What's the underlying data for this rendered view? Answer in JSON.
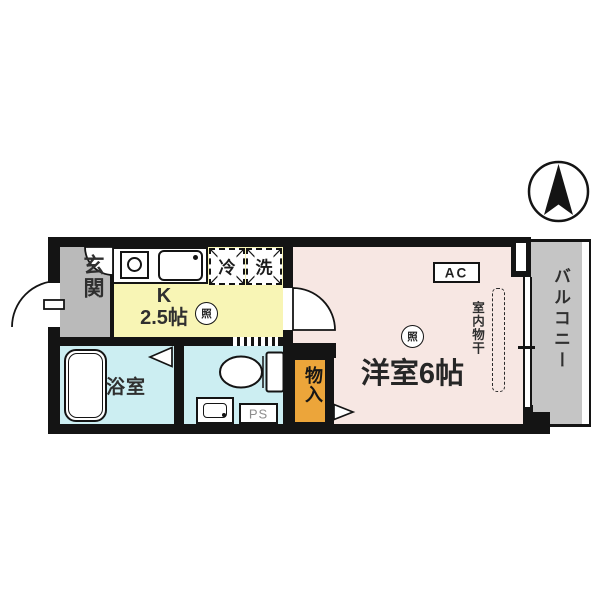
{
  "plan_title": "1K apartment floor plan",
  "rooms": {
    "entrance": {
      "name": "玄関"
    },
    "kitchen": {
      "name_top": "K",
      "name_bottom": "2.5帖"
    },
    "bathroom": {
      "name": "浴室"
    },
    "washroom": {
      "pipe_space": "PS"
    },
    "main_room": {
      "name": "洋室6帖"
    },
    "closet": {
      "name": "物入"
    },
    "balcony": {
      "name": "バルコニー"
    }
  },
  "fixtures": {
    "refrigerator": "冷",
    "washing_machine": "洗",
    "ceiling_light": "照",
    "air_conditioner": "AC",
    "indoor_clothes_drying": "室内物干"
  },
  "colors": {
    "wall": "#141414",
    "kitchen": "#f8f5b5",
    "main": "#f7e7e3",
    "wet": "#cceef2",
    "entrance": "#bababa",
    "balcony": "#c5c5c5",
    "closet": "#eca53a"
  }
}
